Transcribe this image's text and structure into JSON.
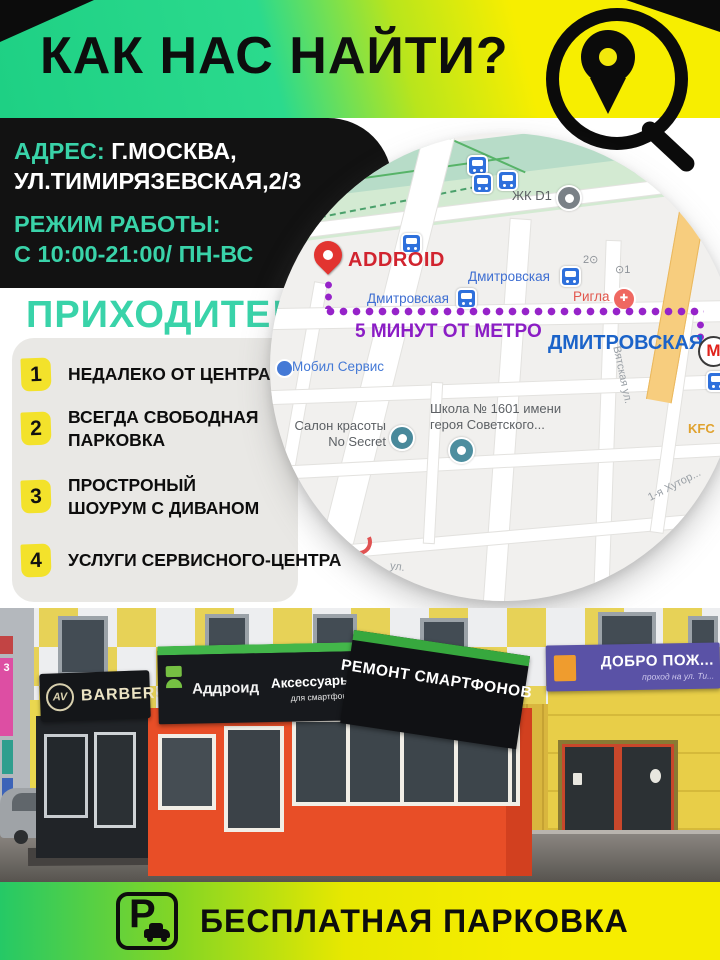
{
  "colors": {
    "teal": "#39d3a9",
    "purple": "#8b1dc5",
    "metro-blue": "#1b63c9",
    "addroid-red": "#d1242f",
    "badge-yellow": "#f3e22b",
    "map-label-blue": "#3f6fd2"
  },
  "header": {
    "title": "КАК НАС НАЙТИ?"
  },
  "address": {
    "label": "АДРЕС:",
    "city": "Г.МОСКВА,",
    "street": "УЛ.ТИМИРЯЗЕВСКАЯ,2/3",
    "hours_label": "РЕЖИМ РАБОТЫ:",
    "hours": "С 10:00-21:00/ ПН-ВС"
  },
  "invite": {
    "title": "ПРИХОДИТЕ!"
  },
  "benefits": [
    {
      "num": "1",
      "line1": "НЕДАЛЕКО ОТ ЦЕНТРА",
      "line2": ""
    },
    {
      "num": "2",
      "line1": "ВСЕГДА СВОБОДНАЯ",
      "line2": "ПАРКОВКА"
    },
    {
      "num": "3",
      "line1": "ПРОСТРОНЫЙ",
      "line2": "ШОУРУМ С ДИВАНОМ"
    },
    {
      "num": "4",
      "line1": "УСЛУГИ СЕРВИСНОГО-ЦЕНТРА",
      "line2": ""
    }
  ],
  "map": {
    "store_label": "ADDROID",
    "route_note": "5 МИНУТ ОТ МЕТРО",
    "metro_station": "ДМИТРОВСКАЯ",
    "metro_letter": "М",
    "labels": {
      "zhk": "ЖК D1",
      "rail1": "Дмитровская",
      "rail2": "Дмитровская",
      "rigla": "Ригла",
      "exit2": "2⊙",
      "exit1": "⊙1",
      "mobil": "Мобил Сервис",
      "salon1": "Салон красоты",
      "salon2": "No Secret",
      "school1": "Школа № 1601 имени",
      "school2": "героя Советского...",
      "kfc": "KFC",
      "vyatskaya": "Вятская ул.",
      "khutor": "1-я Хутор...",
      "ul": "ул."
    }
  },
  "photo": {
    "signs": {
      "side": "3",
      "barbers_logo": "AV",
      "barbers": "BARBERS",
      "addroid": "Аддроид",
      "accessories": "Аксессуары и запчасти",
      "accessories_sub": "для смартфонов и планшетов",
      "repair": "РЕМОНТ СМАРТФОНОВ",
      "welcome": "ДОБРО ПОЖ...",
      "welcome_sub": "проход на ул. Ти..."
    }
  },
  "footer": {
    "parking_letter": "P",
    "text": "БЕСПЛАТНАЯ ПАРКОВКА"
  }
}
